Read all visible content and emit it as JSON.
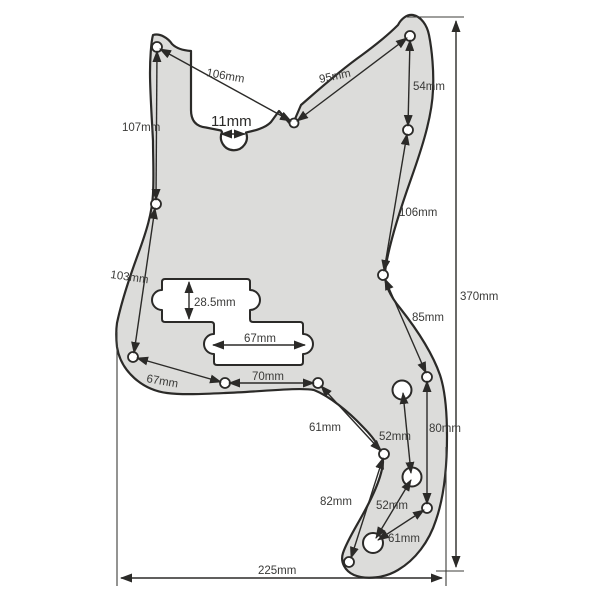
{
  "figure": {
    "background": "#ffffff",
    "outline_color": "#2b2a28",
    "pickguard_fill": "#dcdcda",
    "cutout_fill": "#ffffff",
    "label_color": "#3a3a38"
  },
  "dimensions": {
    "d106_top": "106mm",
    "d95": "95mm",
    "d54": "54mm",
    "d107": "107mm",
    "d11": "11mm",
    "d103": "103mm",
    "d106_right": "106mm",
    "d370": "370mm",
    "d28_5": "28.5mm",
    "d85": "85mm",
    "d67_pickup": "67mm",
    "d67_left": "67mm",
    "d70": "70mm",
    "d61_left": "61mm",
    "d52_top": "52mm",
    "d80": "80mm",
    "d82": "82mm",
    "d52_bottom": "52mm",
    "d61_bottom": "61mm",
    "d225": "225mm"
  }
}
